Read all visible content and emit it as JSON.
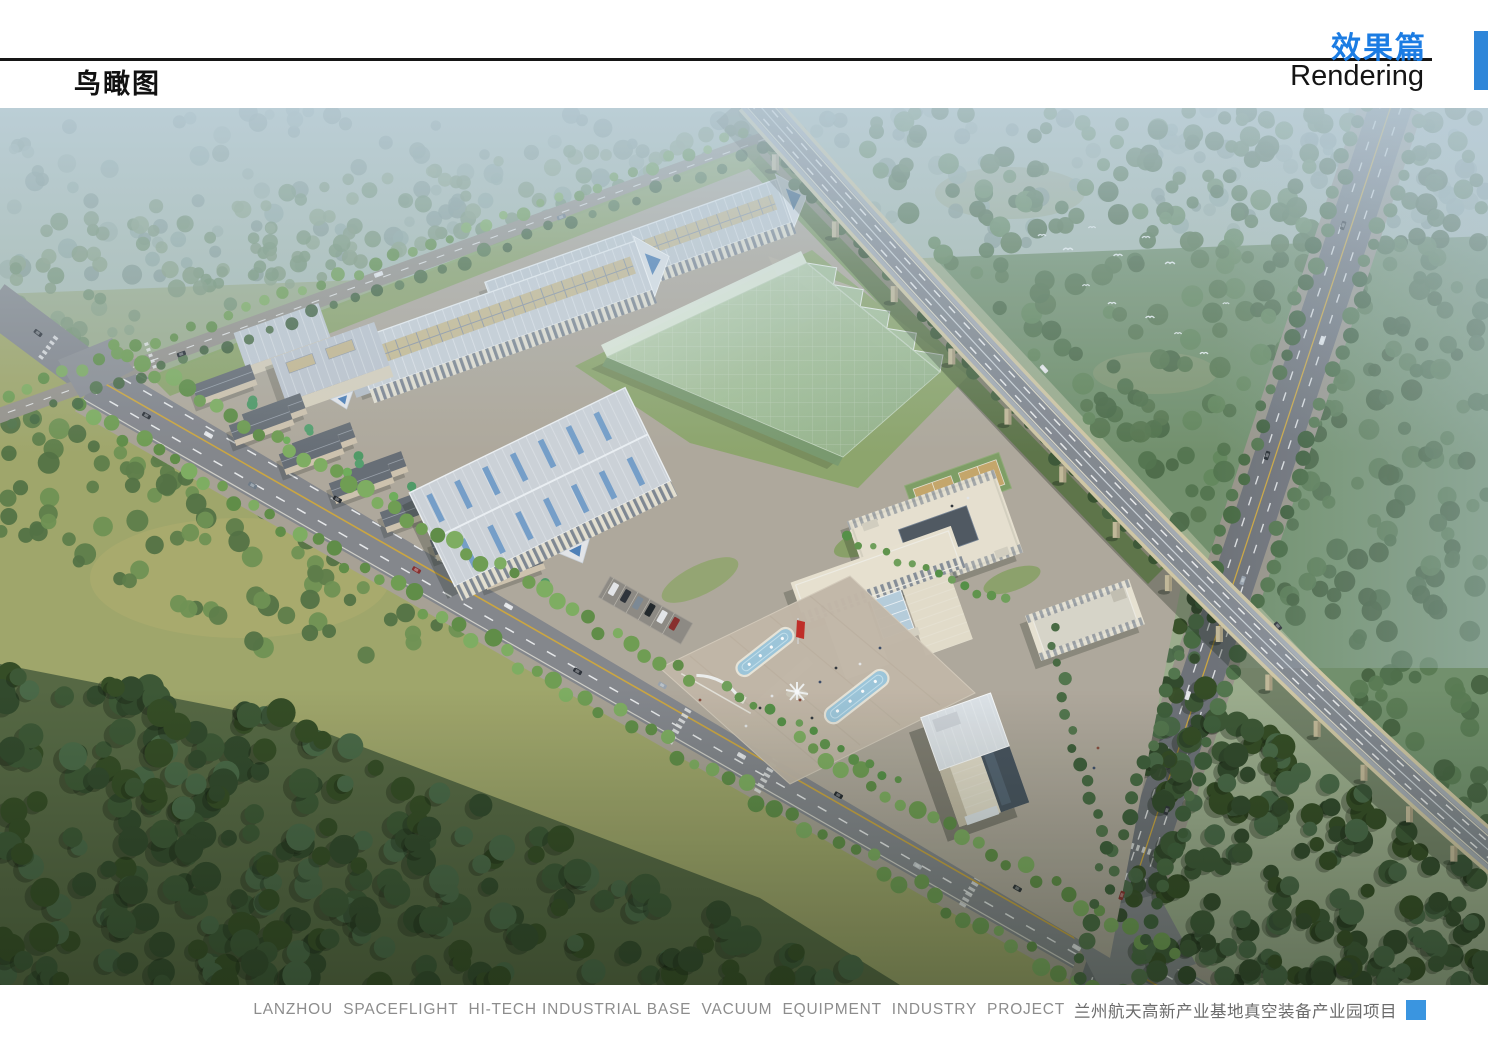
{
  "header": {
    "page_title": "鸟瞰图",
    "section_title_cn": "效果篇",
    "section_title_en": "Rendering",
    "accent_color": "#1b7ce3",
    "accent_bar_color": "#2e86d9",
    "rule_color": "#161616"
  },
  "footer": {
    "caption_en": "LANZHOU  SPACEFLIGHT  HI-TECH INDUSTRIAL BASE  VACUUM  EQUIPMENT  INDUSTRY  PROJECT",
    "caption_cn": "兰州航天高新产业基地真空装备产业园项目",
    "marker_color": "#3a95e0"
  },
  "scene": {
    "kind": "aerial-architectural-rendering",
    "subject": "bird's-eye view of an industrial park campus",
    "elements": {
      "viaduct": "elevated expressway crossing diagonally",
      "boulevard": "tree-lined avenue along the campus front",
      "factories": "long workshop halls with ribbed roofs and skylights",
      "glasshouse": "large green glass enclosure with sawtooth edge",
      "offices": "courtyard office block, headquarters and high-rise tower",
      "plaza": "entrance plaza with two cyan fountain pools, sculpture and red flag",
      "surroundings": "hazy tree fields, dark foreground forest, birds in flight"
    },
    "palette": {
      "haze": "#bcd0dc",
      "field": "#a2a768",
      "forest": "#3a5530",
      "asphalt": "#85868b",
      "campus_ground": "#b2a99b",
      "roof": "#ccd1d8",
      "wall": "#e9e1cd",
      "glass_green": "#a9c49d",
      "pool_water": "#9fc8dc",
      "flag_red": "#c32a22"
    }
  }
}
